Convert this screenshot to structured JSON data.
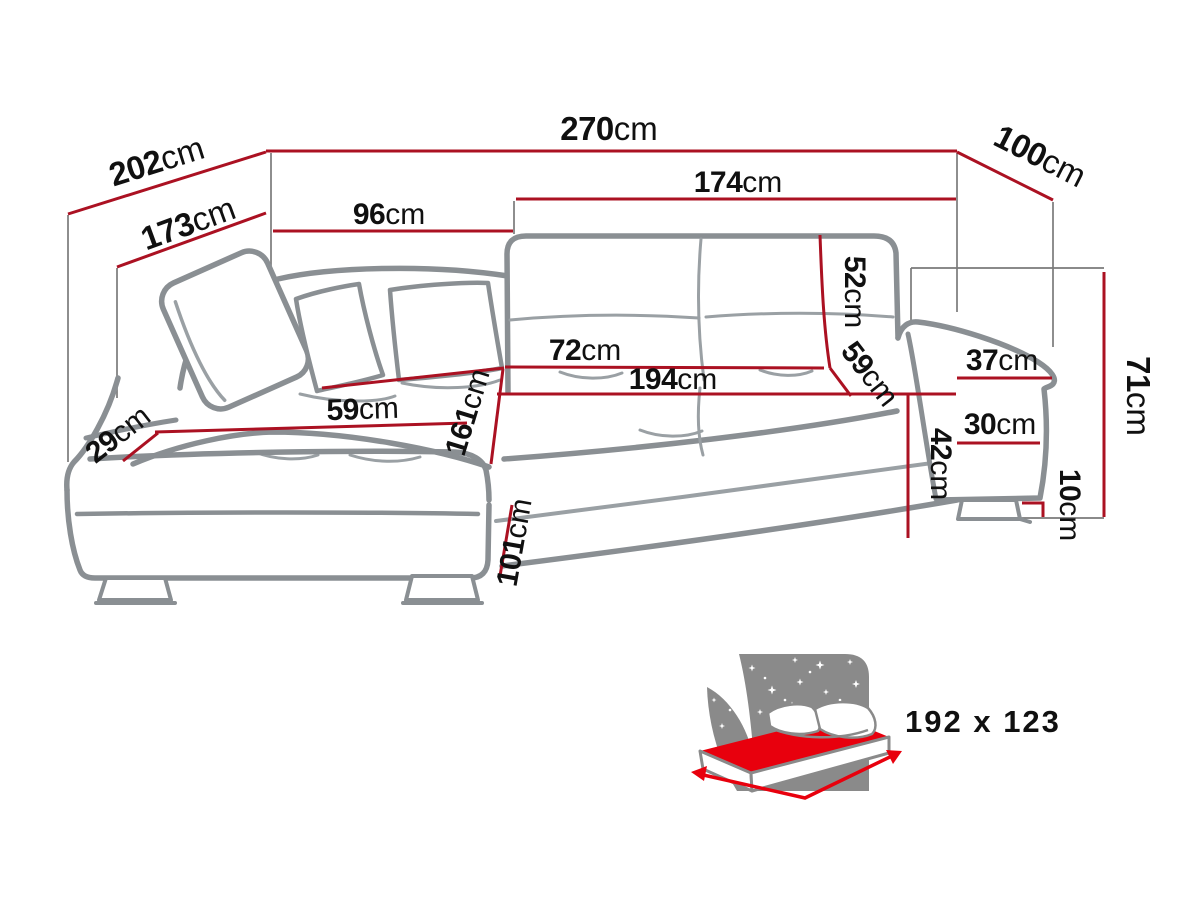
{
  "diagram": {
    "dimensions": {
      "d270": {
        "num": "270",
        "unit": "cm"
      },
      "d202": {
        "num": "202",
        "unit": "cm"
      },
      "d173": {
        "num": "173",
        "unit": "cm"
      },
      "d96": {
        "num": "96",
        "unit": "cm"
      },
      "d174": {
        "num": "174",
        "unit": "cm"
      },
      "d100": {
        "num": "100",
        "unit": "cm"
      },
      "d52": {
        "num": "52",
        "unit": "cm"
      },
      "d59_back": {
        "num": "59",
        "unit": "cm"
      },
      "d72": {
        "num": "72",
        "unit": "cm"
      },
      "d194": {
        "num": "194",
        "unit": "cm"
      },
      "d59_chaise": {
        "num": "59",
        "unit": "cm"
      },
      "d29": {
        "num": "29",
        "unit": "cm"
      },
      "d161": {
        "num": "161",
        "unit": "cm"
      },
      "d101": {
        "num": "101",
        "unit": "cm"
      },
      "d42": {
        "num": "42",
        "unit": "cm"
      },
      "d37": {
        "num": "37",
        "unit": "cm"
      },
      "d30": {
        "num": "30",
        "unit": "cm"
      },
      "d71": {
        "num": "71",
        "unit": "cm"
      },
      "d10": {
        "num": "10",
        "unit": "cm"
      }
    },
    "sleeping_area": {
      "label": "192 x 123"
    },
    "colors": {
      "dim_red": "#ab1122",
      "outline_gray": "#8a8f93",
      "seam_gray": "#9aa0a4",
      "construction_gray": "#7a7a7a",
      "text_black": "#101010",
      "sleep_gray": "#8a8a8a",
      "sleep_label_gray": "#8c8c8c",
      "sleep_red": "#e8000d"
    }
  }
}
